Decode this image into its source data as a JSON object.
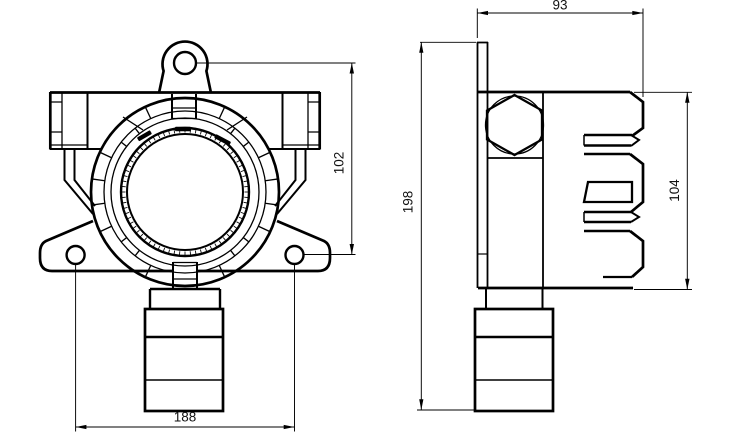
{
  "drawing": {
    "colors": {
      "background": "#ffffff",
      "line": "#000000",
      "dim_text": "#111111"
    },
    "dimensions": {
      "side_width": "93",
      "lug_to_hole": "102",
      "hole_spacing": "188",
      "overall_height": "198",
      "body_height": "104"
    }
  }
}
